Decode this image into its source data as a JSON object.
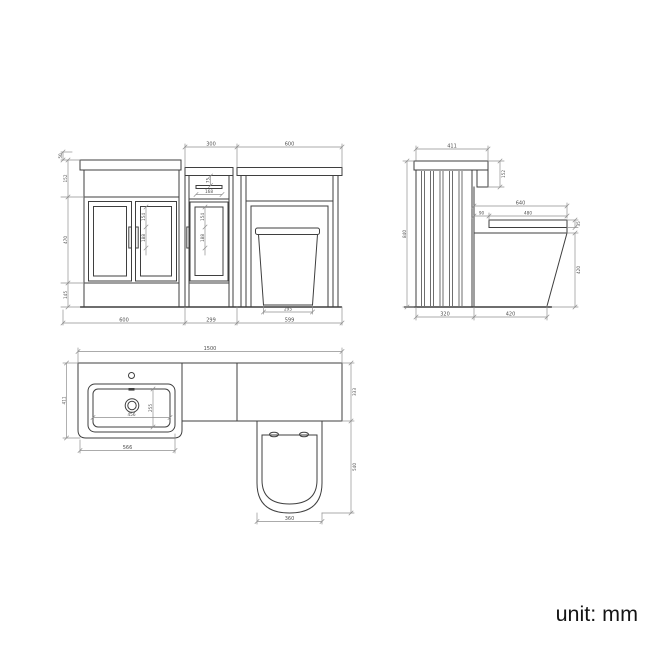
{
  "title": "bathroom-unit-technical-drawing",
  "colors": {
    "object_line": "#3f3f3f",
    "dimension_line": "#8f8f8f",
    "dim_text": "#4f4f4f",
    "footer_text": "#141414",
    "background": "#ffffff"
  },
  "front": {
    "top_dims": {
      "wc_unit_width": "300",
      "toilet_section_width": "600"
    },
    "left_dims": {
      "upstand": "50",
      "top_band": "152",
      "door_height": "470",
      "plinth": "145"
    },
    "vanity_handle_dims": {
      "upper": "154",
      "lower": "188"
    },
    "wc_unit_dims": {
      "drawer_gap": "75",
      "handle_width": "168",
      "upper": "154",
      "lower": "188"
    },
    "toilet_base_width": "295",
    "bottom_dims": {
      "vanity_width": "600",
      "wc_unit_width": "299",
      "toilet_section_width": "599"
    }
  },
  "side": {
    "worktop_depth": "411",
    "band_height": "152",
    "overall_height": "840",
    "total_seat_depth": "640",
    "back_gap": "90",
    "seat_depth": "480",
    "seat_thickness": "35",
    "seat_height": "420",
    "panel_depth": "320",
    "toilet_projection": "420"
  },
  "plan": {
    "total_width": "1500",
    "vanity_depth": "411",
    "run_depth": "333",
    "basin_inner_width": "456",
    "basin_inner_depth": "255",
    "basin_outer_width": "566",
    "toilet_length": "540",
    "toilet_width": "360"
  },
  "footer": {
    "unit_label": "unit: mm"
  }
}
